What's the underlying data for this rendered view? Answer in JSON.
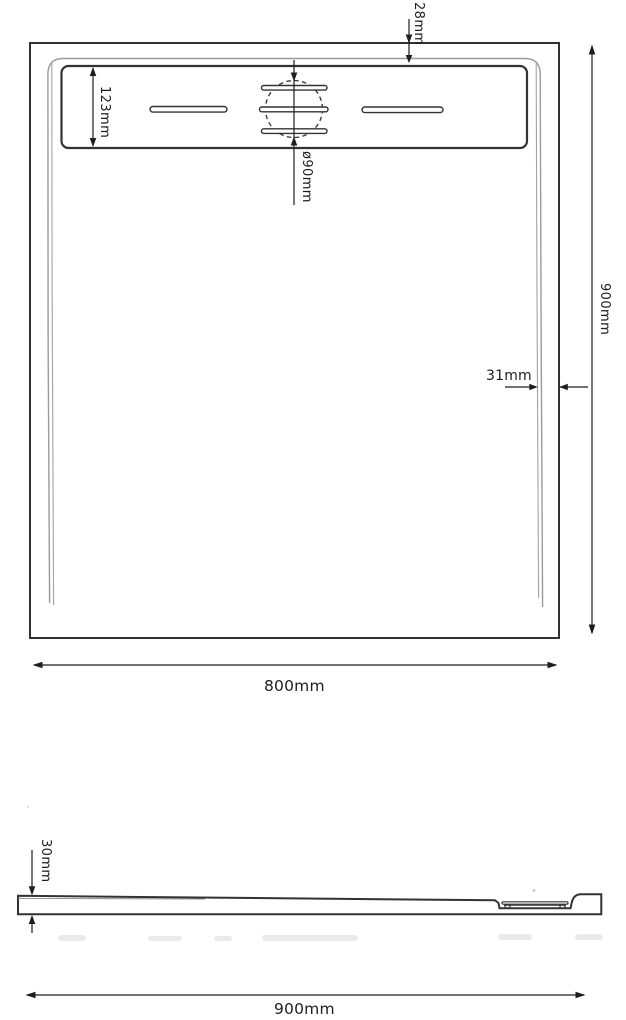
{
  "drawing": {
    "type": "shower-tray technical drawing, top view and side profile",
    "line_color": "#333333",
    "inner_line_color": "#9b9b9b",
    "views": {
      "top_view": {
        "dims": {
          "rim_top_offset": "28mm",
          "drain_channel_width": "123mm",
          "drain_diameter": "ø90mm",
          "overall_length": "900mm",
          "rim_side_offset": "31mm",
          "overall_width": "800mm"
        }
      },
      "side_view": {
        "dims": {
          "profile_height": "30mm",
          "overall_length": "900mm"
        }
      }
    }
  }
}
